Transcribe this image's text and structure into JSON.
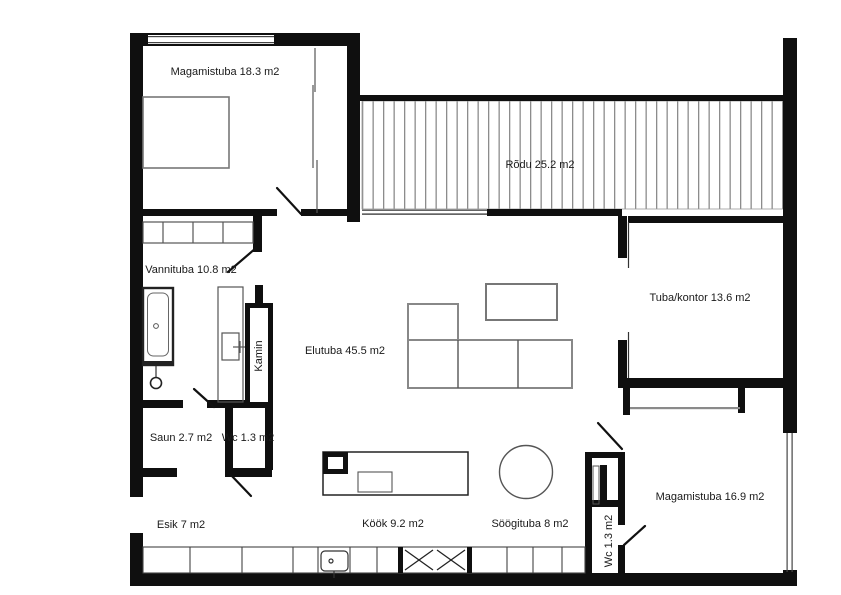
{
  "canvas": {
    "width": 841,
    "height": 595,
    "background": "#ffffff"
  },
  "colors": {
    "wall": "#0f0f0f",
    "furniture_line": "#777777",
    "thin_line": "#555555",
    "door_line": "#111111",
    "deck_stripe": "#8c8c8c",
    "slider_gray": "#8a8a8a",
    "label_text": "#1a1a1a"
  },
  "floorplan": {
    "type": "apartment-floor-plan",
    "rooms": [
      {
        "id": "magamistuba-1",
        "name": "Magamistuba",
        "area": "18.3 m2",
        "label": "Magamistuba 18.3 m2",
        "cx": 225,
        "cy": 72,
        "rotate": 0
      },
      {
        "id": "rodu",
        "name": "Rõdu",
        "area": "25.2 m2",
        "label": "Rõdu 25.2 m2",
        "cx": 540,
        "cy": 165,
        "rotate": 0
      },
      {
        "id": "vannituba",
        "name": "Vannituba",
        "area": "10.8 m2",
        "label": "Vannituba 10.8 m2",
        "cx": 191,
        "cy": 270,
        "rotate": 0
      },
      {
        "id": "elutuba",
        "name": "Elutuba",
        "area": "45.5 m2",
        "label": "Elutuba 45.5 m2",
        "cx": 345,
        "cy": 351,
        "rotate": 0
      },
      {
        "id": "tuba-kontor",
        "name": "Tuba/kontor",
        "area": "13.6 m2",
        "label": "Tuba/kontor 13.6 m2",
        "cx": 700,
        "cy": 298,
        "rotate": 0
      },
      {
        "id": "kamin",
        "name": "Kamin",
        "area": "",
        "label": "Kamin",
        "cx": 259,
        "cy": 356,
        "rotate": -90
      },
      {
        "id": "saun",
        "name": "Saun",
        "area": "2.7 m2",
        "label": "Saun 2.7 m2",
        "cx": 181,
        "cy": 438,
        "rotate": 0
      },
      {
        "id": "wc-1",
        "name": "Wc",
        "area": "1.3 m2",
        "label": "Wc 1.3 m2",
        "cx": 248,
        "cy": 438,
        "rotate": 0
      },
      {
        "id": "esik",
        "name": "Esik",
        "area": "7 m2",
        "label": "Esik 7 m2",
        "cx": 181,
        "cy": 525,
        "rotate": 0
      },
      {
        "id": "kook",
        "name": "Köök",
        "area": "9.2 m2",
        "label": "Köök 9.2 m2",
        "cx": 393,
        "cy": 524,
        "rotate": 0
      },
      {
        "id": "soogituba",
        "name": "Söögituba",
        "area": "8 m2",
        "label": "Söögituba 8 m2",
        "cx": 530,
        "cy": 524,
        "rotate": 0
      },
      {
        "id": "magamistuba-2",
        "name": "Magamistuba",
        "area": "16.9 m2",
        "label": "Magamistuba 16.9 m2",
        "cx": 710,
        "cy": 497,
        "rotate": 0
      },
      {
        "id": "wc-2",
        "name": "Wc",
        "area": "1.3 m2",
        "label": "Wc 1.3 m2",
        "cx": 609,
        "cy": 541,
        "rotate": -90
      }
    ]
  }
}
